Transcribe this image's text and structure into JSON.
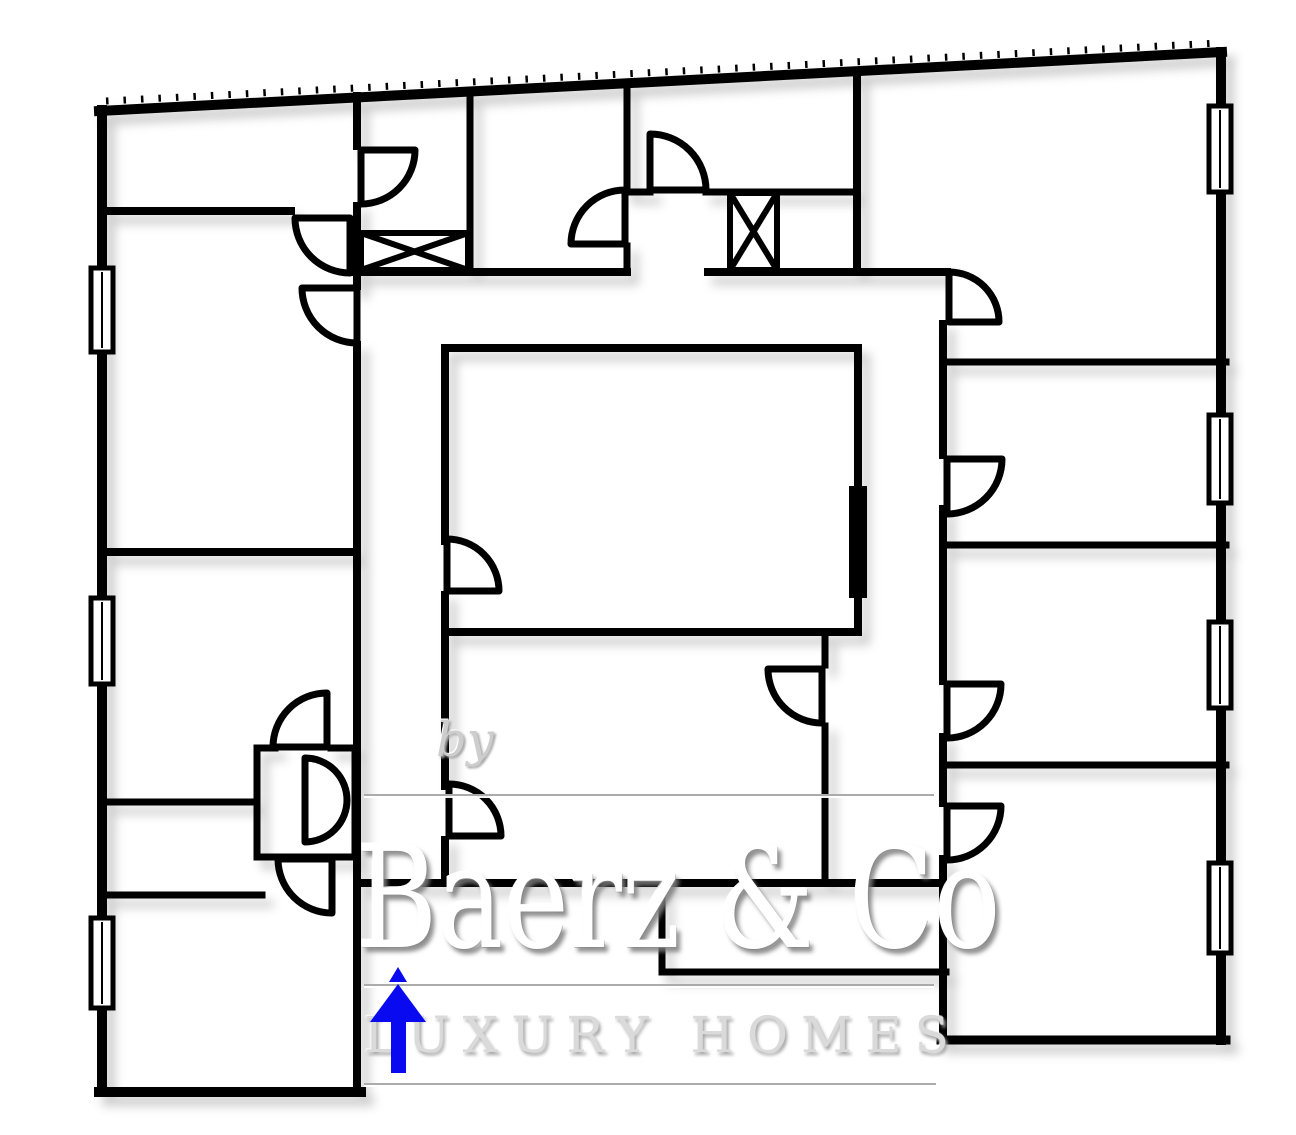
{
  "watermark": {
    "by": "by",
    "brand": "Baerz & Co",
    "tagline": "LUXURY HOMES"
  },
  "colors": {
    "wall": "#000000",
    "room_fill": "#ffffff",
    "arrow_blue": "#0a0af0",
    "watermark_grey": "#cdcdcd"
  },
  "plan": {
    "wall_thickness": 8,
    "walls": [
      {
        "x1": 99,
        "y1": 111,
        "x2": 1222,
        "y2": 52,
        "w": 10,
        "name": "exterior-top"
      },
      {
        "x1": 1221,
        "y1": 52,
        "x2": 1221,
        "y2": 1040,
        "w": 10,
        "name": "exterior-right"
      },
      {
        "x1": 941,
        "y1": 1040,
        "x2": 1226,
        "y2": 1040,
        "w": 9,
        "name": "exterior-bottom-right"
      },
      {
        "x1": 102,
        "y1": 110,
        "x2": 102,
        "y2": 1092,
        "w": 10,
        "name": "exterior-left"
      },
      {
        "x1": 99,
        "y1": 1092,
        "x2": 361,
        "y2": 1092,
        "w": 10,
        "name": "exterior-bottom-left"
      },
      {
        "x1": 943,
        "y1": 324,
        "x2": 943,
        "y2": 455,
        "w": 8,
        "name": "right-wing-left"
      },
      {
        "x1": 943,
        "y1": 509,
        "x2": 943,
        "y2": 681,
        "w": 8,
        "name": "right-wing-left"
      },
      {
        "x1": 943,
        "y1": 737,
        "x2": 943,
        "y2": 803,
        "w": 8,
        "name": "right-wing-left"
      },
      {
        "x1": 943,
        "y1": 859,
        "x2": 943,
        "y2": 1040,
        "w": 8,
        "name": "right-wing-left"
      },
      {
        "x1": 357,
        "y1": 96,
        "x2": 357,
        "y2": 146,
        "w": 8,
        "name": "left-wing-right"
      },
      {
        "x1": 357,
        "y1": 206,
        "x2": 357,
        "y2": 286,
        "w": 8,
        "name": "left-wing-right"
      },
      {
        "x1": 357,
        "y1": 345,
        "x2": 357,
        "y2": 1092,
        "w": 8,
        "name": "left-wing-right"
      },
      {
        "x1": 102,
        "y1": 211,
        "x2": 291,
        "y2": 211,
        "w": 8,
        "name": "partition-y211"
      },
      {
        "x1": 102,
        "y1": 552,
        "x2": 357,
        "y2": 552,
        "w": 8,
        "name": "partition-y552"
      },
      {
        "x1": 102,
        "y1": 802,
        "x2": 254,
        "y2": 802,
        "w": 7,
        "name": "partition-y802"
      },
      {
        "x1": 102,
        "y1": 895,
        "x2": 262,
        "y2": 895,
        "w": 7,
        "name": "partition-y895"
      },
      {
        "x1": 470,
        "y1": 94,
        "x2": 470,
        "y2": 272,
        "w": 7,
        "name": "partition-x470"
      },
      {
        "x1": 627,
        "y1": 84,
        "x2": 627,
        "y2": 186,
        "w": 7,
        "name": "partition-x627"
      },
      {
        "x1": 627,
        "y1": 246,
        "x2": 627,
        "y2": 272,
        "w": 7,
        "name": "partition-x627"
      },
      {
        "x1": 857,
        "y1": 71,
        "x2": 857,
        "y2": 272,
        "w": 8,
        "name": "partition-x857"
      },
      {
        "x1": 627,
        "y1": 192,
        "x2": 650,
        "y2": 192,
        "w": 7,
        "name": "partition-y192"
      },
      {
        "x1": 706,
        "y1": 192,
        "x2": 857,
        "y2": 192,
        "w": 7,
        "name": "partition-y192"
      },
      {
        "x1": 353,
        "y1": 272,
        "x2": 627,
        "y2": 272,
        "w": 8,
        "name": "hall-top"
      },
      {
        "x1": 708,
        "y1": 272,
        "x2": 947,
        "y2": 272,
        "w": 8,
        "name": "hall-top"
      },
      {
        "x1": 445,
        "y1": 348,
        "x2": 858,
        "y2": 348,
        "w": 8,
        "name": "inner-court-top"
      },
      {
        "x1": 445,
        "y1": 348,
        "x2": 445,
        "y2": 541,
        "w": 8,
        "name": "inner-court-left"
      },
      {
        "x1": 445,
        "y1": 595,
        "x2": 445,
        "y2": 786,
        "w": 8,
        "name": "inner-court-left"
      },
      {
        "x1": 445,
        "y1": 840,
        "x2": 445,
        "y2": 883,
        "w": 8,
        "name": "inner-court-left"
      },
      {
        "x1": 858,
        "y1": 348,
        "x2": 858,
        "y2": 632,
        "w": 8,
        "name": "inner-court-right"
      },
      {
        "x1": 445,
        "y1": 632,
        "x2": 858,
        "y2": 632,
        "w": 8,
        "name": "inner-court-bottom"
      },
      {
        "x1": 825,
        "y1": 632,
        "x2": 825,
        "y2": 665,
        "w": 7,
        "name": "partition-x825"
      },
      {
        "x1": 825,
        "y1": 726,
        "x2": 825,
        "y2": 883,
        "w": 7,
        "name": "partition-x825"
      },
      {
        "x1": 357,
        "y1": 883,
        "x2": 943,
        "y2": 883,
        "w": 8,
        "name": "central-bottom"
      },
      {
        "x1": 662,
        "y1": 883,
        "x2": 662,
        "y2": 972,
        "w": 7,
        "name": "stub-left"
      },
      {
        "x1": 662,
        "y1": 972,
        "x2": 946,
        "y2": 972,
        "w": 7,
        "name": "stub-bottom"
      },
      {
        "x1": 943,
        "y1": 362,
        "x2": 1226,
        "y2": 362,
        "w": 7,
        "name": "right-partition-y362"
      },
      {
        "x1": 943,
        "y1": 545,
        "x2": 1226,
        "y2": 545,
        "w": 7,
        "name": "right-partition-y545"
      },
      {
        "x1": 943,
        "y1": 765,
        "x2": 1226,
        "y2": 765,
        "w": 7,
        "name": "right-partition-y765"
      },
      {
        "x1": 257,
        "y1": 748,
        "x2": 275,
        "y2": 748,
        "w": 7,
        "name": "closet-top"
      },
      {
        "x1": 331,
        "y1": 748,
        "x2": 355,
        "y2": 748,
        "w": 7,
        "name": "closet-top"
      },
      {
        "x1": 257,
        "y1": 748,
        "x2": 257,
        "y2": 857,
        "w": 7,
        "name": "closet-left"
      },
      {
        "x1": 257,
        "y1": 857,
        "x2": 355,
        "y2": 857,
        "w": 7,
        "name": "closet-bottom"
      },
      {
        "x1": 355,
        "y1": 748,
        "x2": 355,
        "y2": 857,
        "w": 7,
        "name": "closet-right"
      }
    ],
    "hatch_tick_line": {
      "x1": 106,
      "y1": 101,
      "x2": 1218,
      "y2": 43,
      "w": 7,
      "dash": "2.5 15"
    },
    "windows": [
      {
        "x": 91,
        "y": 268,
        "w": 22,
        "h": 84,
        "name": "window-left-1"
      },
      {
        "x": 91,
        "y": 598,
        "w": 22,
        "h": 86,
        "name": "window-left-2"
      },
      {
        "x": 91,
        "y": 918,
        "w": 22,
        "h": 90,
        "name": "window-left-3"
      },
      {
        "x": 1209,
        "y": 106,
        "w": 22,
        "h": 86,
        "name": "window-right-1"
      },
      {
        "x": 1209,
        "y": 415,
        "w": 22,
        "h": 88,
        "name": "window-right-2"
      },
      {
        "x": 1209,
        "y": 622,
        "w": 22,
        "h": 86,
        "name": "window-right-3"
      },
      {
        "x": 1209,
        "y": 863,
        "w": 22,
        "h": 90,
        "name": "window-right-4"
      }
    ],
    "shaft_boxes": [
      {
        "x": 361,
        "y": 233,
        "w": 107,
        "h": 37,
        "name": "shaft-box-1"
      },
      {
        "x": 730,
        "y": 193,
        "w": 47,
        "h": 77,
        "name": "shaft-box-2"
      }
    ],
    "doors": [
      {
        "hx": 350,
        "hy": 218,
        "r": 55,
        "a1": 90,
        "a2": 180,
        "half": false,
        "name": "door-topleft-room"
      },
      {
        "hx": 357,
        "hy": 288,
        "r": 55,
        "a1": 90,
        "a2": 180,
        "half": false,
        "name": "door-left-middle-room"
      },
      {
        "hx": 361,
        "hy": 150,
        "r": 54,
        "a1": 0,
        "a2": 90,
        "half": false,
        "name": "door-small-room"
      },
      {
        "hx": 625,
        "hy": 244,
        "r": 54,
        "a1": 180,
        "a2": 270,
        "half": false,
        "name": "door-top-center-left"
      },
      {
        "hx": 650,
        "hy": 190,
        "r": 56,
        "a1": 270,
        "a2": 360,
        "half": false,
        "name": "door-top-center"
      },
      {
        "hx": 949,
        "hy": 322,
        "r": 50,
        "a1": 270,
        "a2": 360,
        "half": false,
        "name": "door-top-right-room"
      },
      {
        "hx": 947,
        "hy": 459,
        "r": 55,
        "a1": 0,
        "a2": 90,
        "half": false,
        "name": "door-right-room-2"
      },
      {
        "hx": 947,
        "hy": 684,
        "r": 54,
        "a1": 0,
        "a2": 90,
        "half": false,
        "name": "door-right-room-3"
      },
      {
        "hx": 947,
        "hy": 806,
        "r": 54,
        "a1": 0,
        "a2": 90,
        "half": false,
        "name": "door-right-room-4"
      },
      {
        "hx": 447,
        "hy": 591,
        "r": 52,
        "a1": 270,
        "a2": 360,
        "half": false,
        "name": "door-inner-court"
      },
      {
        "hx": 449,
        "hy": 836,
        "r": 52,
        "a1": 270,
        "a2": 360,
        "half": false,
        "name": "door-bottom-center-left"
      },
      {
        "hx": 822,
        "hy": 669,
        "r": 54,
        "a1": 90,
        "a2": 180,
        "half": false,
        "name": "door-bottom-center-right"
      },
      {
        "hx": 327,
        "hy": 747,
        "r": 54,
        "a1": 180,
        "a2": 270,
        "half": false,
        "name": "door-closet-north"
      },
      {
        "hx": 332,
        "hy": 859,
        "r": 54,
        "a1": 90,
        "a2": 180,
        "half": false,
        "name": "door-closet-south"
      },
      {
        "hx": 305,
        "hy": 800,
        "r": 42,
        "a1": 270,
        "a2": 450,
        "half": true,
        "name": "door-closet-swing"
      }
    ],
    "black_bar": {
      "x": 849,
      "y": 486,
      "w": 18,
      "h": 112,
      "name": "sliding-door-bar"
    },
    "north_arrow": {
      "shaft": {
        "x": 391,
        "y": 1015,
        "w": 15,
        "h": 58
      },
      "head": [
        [
          370,
          1022
        ],
        [
          398,
          984
        ],
        [
          426,
          1022
        ]
      ],
      "tip": [
        [
          389,
          982
        ],
        [
          398,
          967
        ],
        [
          407,
          982
        ]
      ]
    }
  }
}
